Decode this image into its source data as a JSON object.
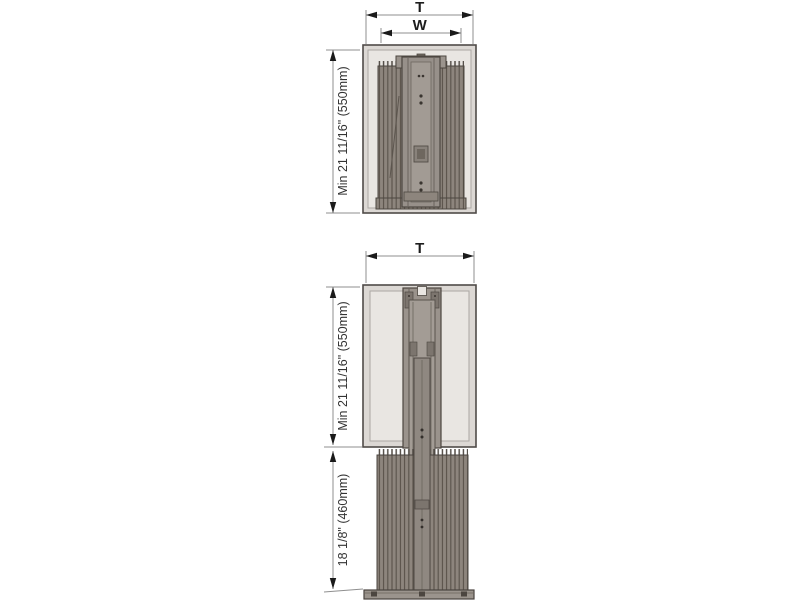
{
  "figures": {
    "upper": {
      "total_width_label": "T",
      "inner_width_label": "W",
      "cabinet_height_label": "Min 21 11/16\" (550mm)"
    },
    "lower": {
      "total_width_label": "T",
      "cabinet_height_label": "Min 21 11/16\" (550mm)",
      "extension_height_label": "18 1/8\" (460mm)"
    }
  },
  "colors": {
    "background": "#ffffff",
    "cabinet_frame": "#dcd8d4",
    "cabinet_interior": "#e9e6e2",
    "outline": "#4c4640",
    "mechanism": "#97908a",
    "mechanism_light": "#a39c95",
    "basket": "#8d857d",
    "base_plate": "#9b948d",
    "dimension_line": "#8f8f8f",
    "dimension_text": "#1d1d1d"
  }
}
